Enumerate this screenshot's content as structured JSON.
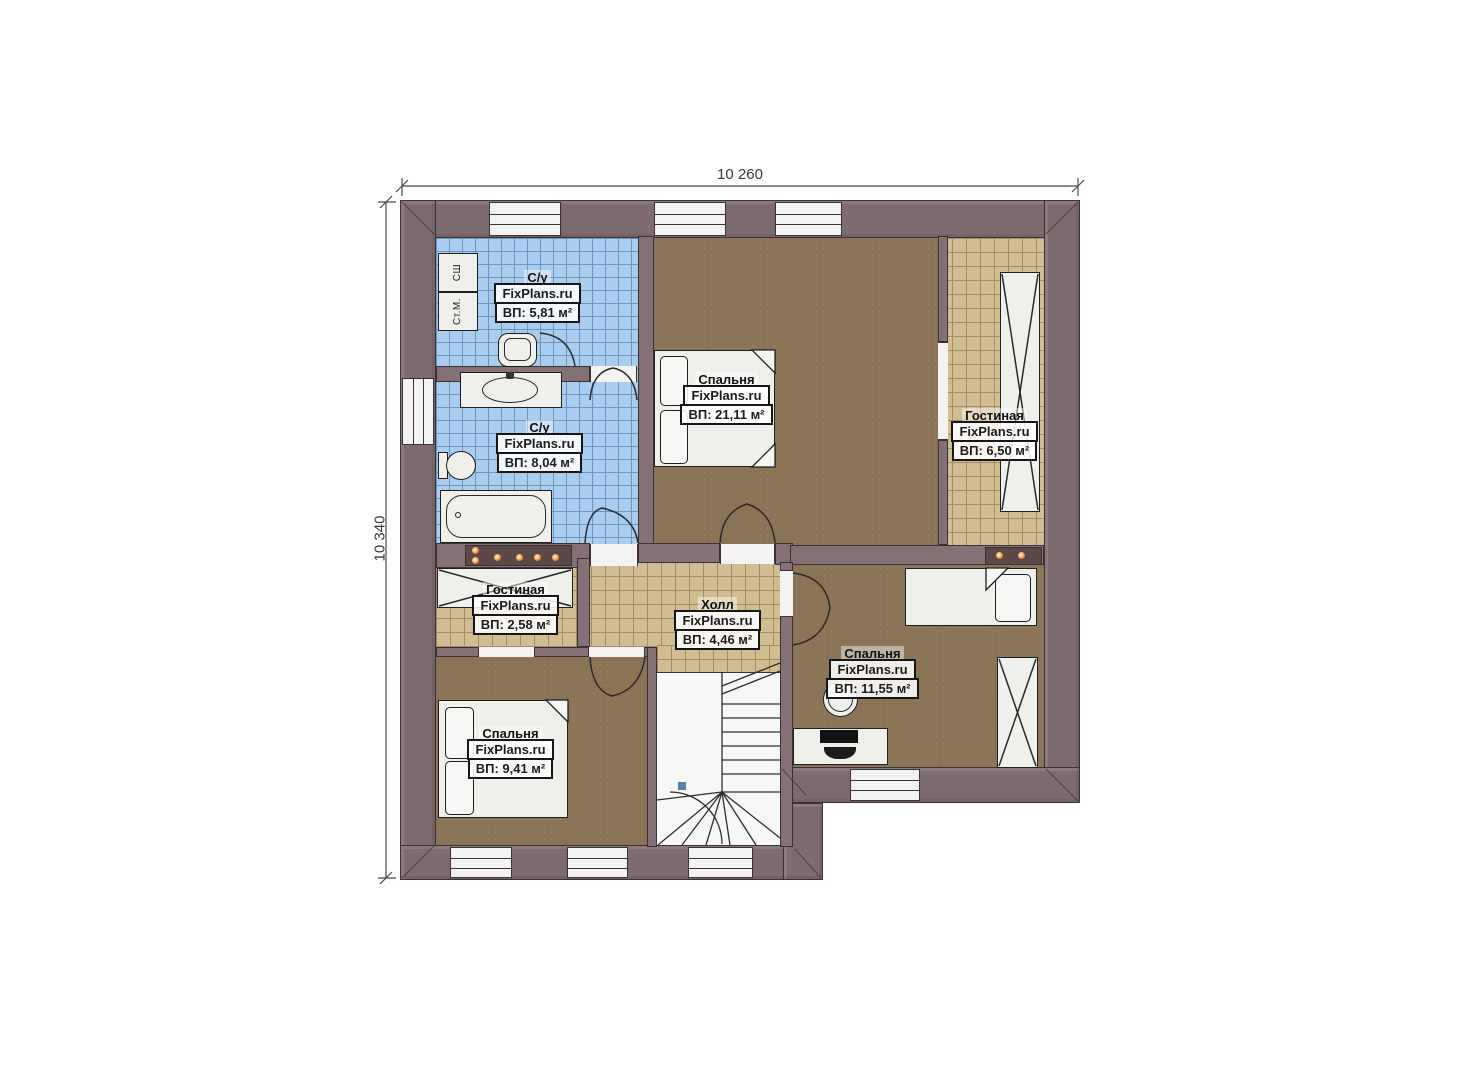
{
  "brand": "FixPlans.ru",
  "dimensions": {
    "width_mm": "10 260",
    "height_mm": "10 340"
  },
  "rooms": [
    {
      "key": "bath-top",
      "name": "С/у",
      "area": "ВП: 5,81 м²"
    },
    {
      "key": "bath-main",
      "name": "С/у",
      "area": "ВП: 8,04 м²"
    },
    {
      "key": "bedroom-master",
      "name": "Спальня",
      "area": "ВП: 21,11 м²"
    },
    {
      "key": "living-right",
      "name": "Гостиная",
      "area": "ВП: 6,50 м²"
    },
    {
      "key": "hall",
      "name": "Холл",
      "area": "ВП: 4,46 м²"
    },
    {
      "key": "living-left",
      "name": "Гостиная",
      "area": "ВП: 2,58 м²"
    },
    {
      "key": "bedroom-left",
      "name": "Спальня",
      "area": "ВП: 9,41 м²"
    },
    {
      "key": "bedroom-right",
      "name": "Спальня",
      "area": "ВП: 11,55 м²"
    }
  ],
  "appliances": {
    "drying_cabinet": "СШ",
    "washing_machine": "Ст.М."
  },
  "colors": {
    "wall": "#7e6b70",
    "tile_blue": "#a9cdee",
    "tile_tan": "#d2bc92",
    "floor_brown": "#8b7456",
    "accent_dot": "#e07b28"
  }
}
